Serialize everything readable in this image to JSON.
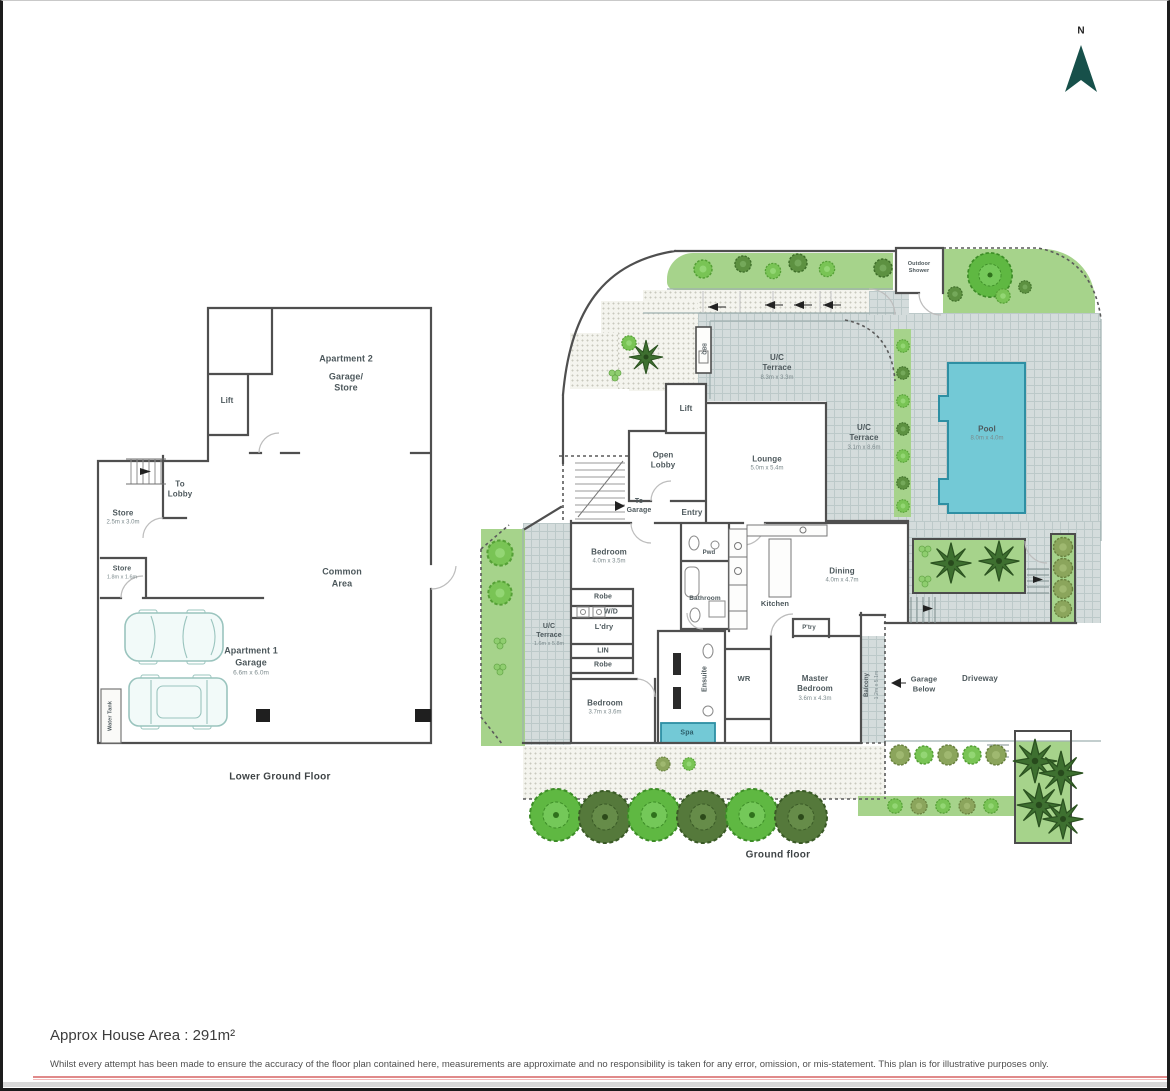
{
  "page": {
    "north": "N",
    "area": "Approx House Area : 291m²",
    "disclaimer": "Whilst every attempt has been made to ensure the accuracy of the floor plan contained here, measurements are approximate and no responsibility is taken for any error, omission, or mis-statement. This plan is for illustrative purposes only."
  },
  "colors": {
    "wall": "#4f4f4f",
    "pool": "#73c9d6",
    "garden": "#a6d38b",
    "paving": "#d4dcdc",
    "redline": "#e08a8a"
  },
  "lg": {
    "caption": "Lower Ground Floor",
    "apartment2_1": "Apartment 2",
    "apartment2_2": "Garage/",
    "apartment2_3": "Store",
    "lift": "Lift",
    "to_lobby_1": "To",
    "to_lobby_2": "Lobby",
    "store1": "Store",
    "store1_dims": "2.5m x 3.0m",
    "store2": "Store",
    "store2_dims": "1.8m x 1.6m",
    "common_1": "Common",
    "common_2": "Area",
    "apt1_1": "Apartment 1",
    "apt1_2": "Garage",
    "apt1_dims": "6.6m x 6.0m",
    "water_tank": "Water Tank"
  },
  "gf": {
    "caption": "Ground floor",
    "outdoor_shower_1": "Outdoor",
    "outdoor_shower_2": "Shower",
    "bbq": "BBQ",
    "uct1_1": "U/C",
    "uct1_2": "Terrace",
    "uct1_dims": "8.3m x 3.3m",
    "uct2_1": "U/C",
    "uct2_2": "Terrace",
    "uct2_dims": "3.1m x 8.6m",
    "uct3_1": "U/C",
    "uct3_2": "Terrace",
    "uct3_dims": "1.6m x 5.8m",
    "pool": "Pool",
    "pool_dims": "8.0m x 4.0m",
    "lift": "Lift",
    "open_lobby_1": "Open",
    "open_lobby_2": "Lobby",
    "lounge": "Lounge",
    "lounge_dims": "5.0m x 5.4m",
    "to_garage_1": "To",
    "to_garage_2": "Garage",
    "entry": "Entry",
    "bedroom1": "Bedroom",
    "bedroom1_dims": "4.0m x 3.5m",
    "robe1": "Robe",
    "wd": "W/D",
    "ldry": "L'dry",
    "lin": "LIN",
    "robe2": "Robe",
    "bedroom2": "Bedroom",
    "bedroom2_dims": "3.7m x 3.6m",
    "ensuite": "Ensuite",
    "spa": "Spa",
    "pwd": "Pwd",
    "bathroom": "Bathroom",
    "kitchen": "Kitchen",
    "ptry": "P'try",
    "dining": "Dining",
    "dining_dims": "4.0m x 4.7m",
    "wr": "WR",
    "master_1": "Master",
    "master_2": "Bedroom",
    "master_dims": "3.6m x 4.3m",
    "balcony": "Balcony",
    "balcony_dims": "1.2m x 5.1m",
    "garage_below_1": "Garage",
    "garage_below_2": "Below",
    "driveway": "Driveway"
  }
}
